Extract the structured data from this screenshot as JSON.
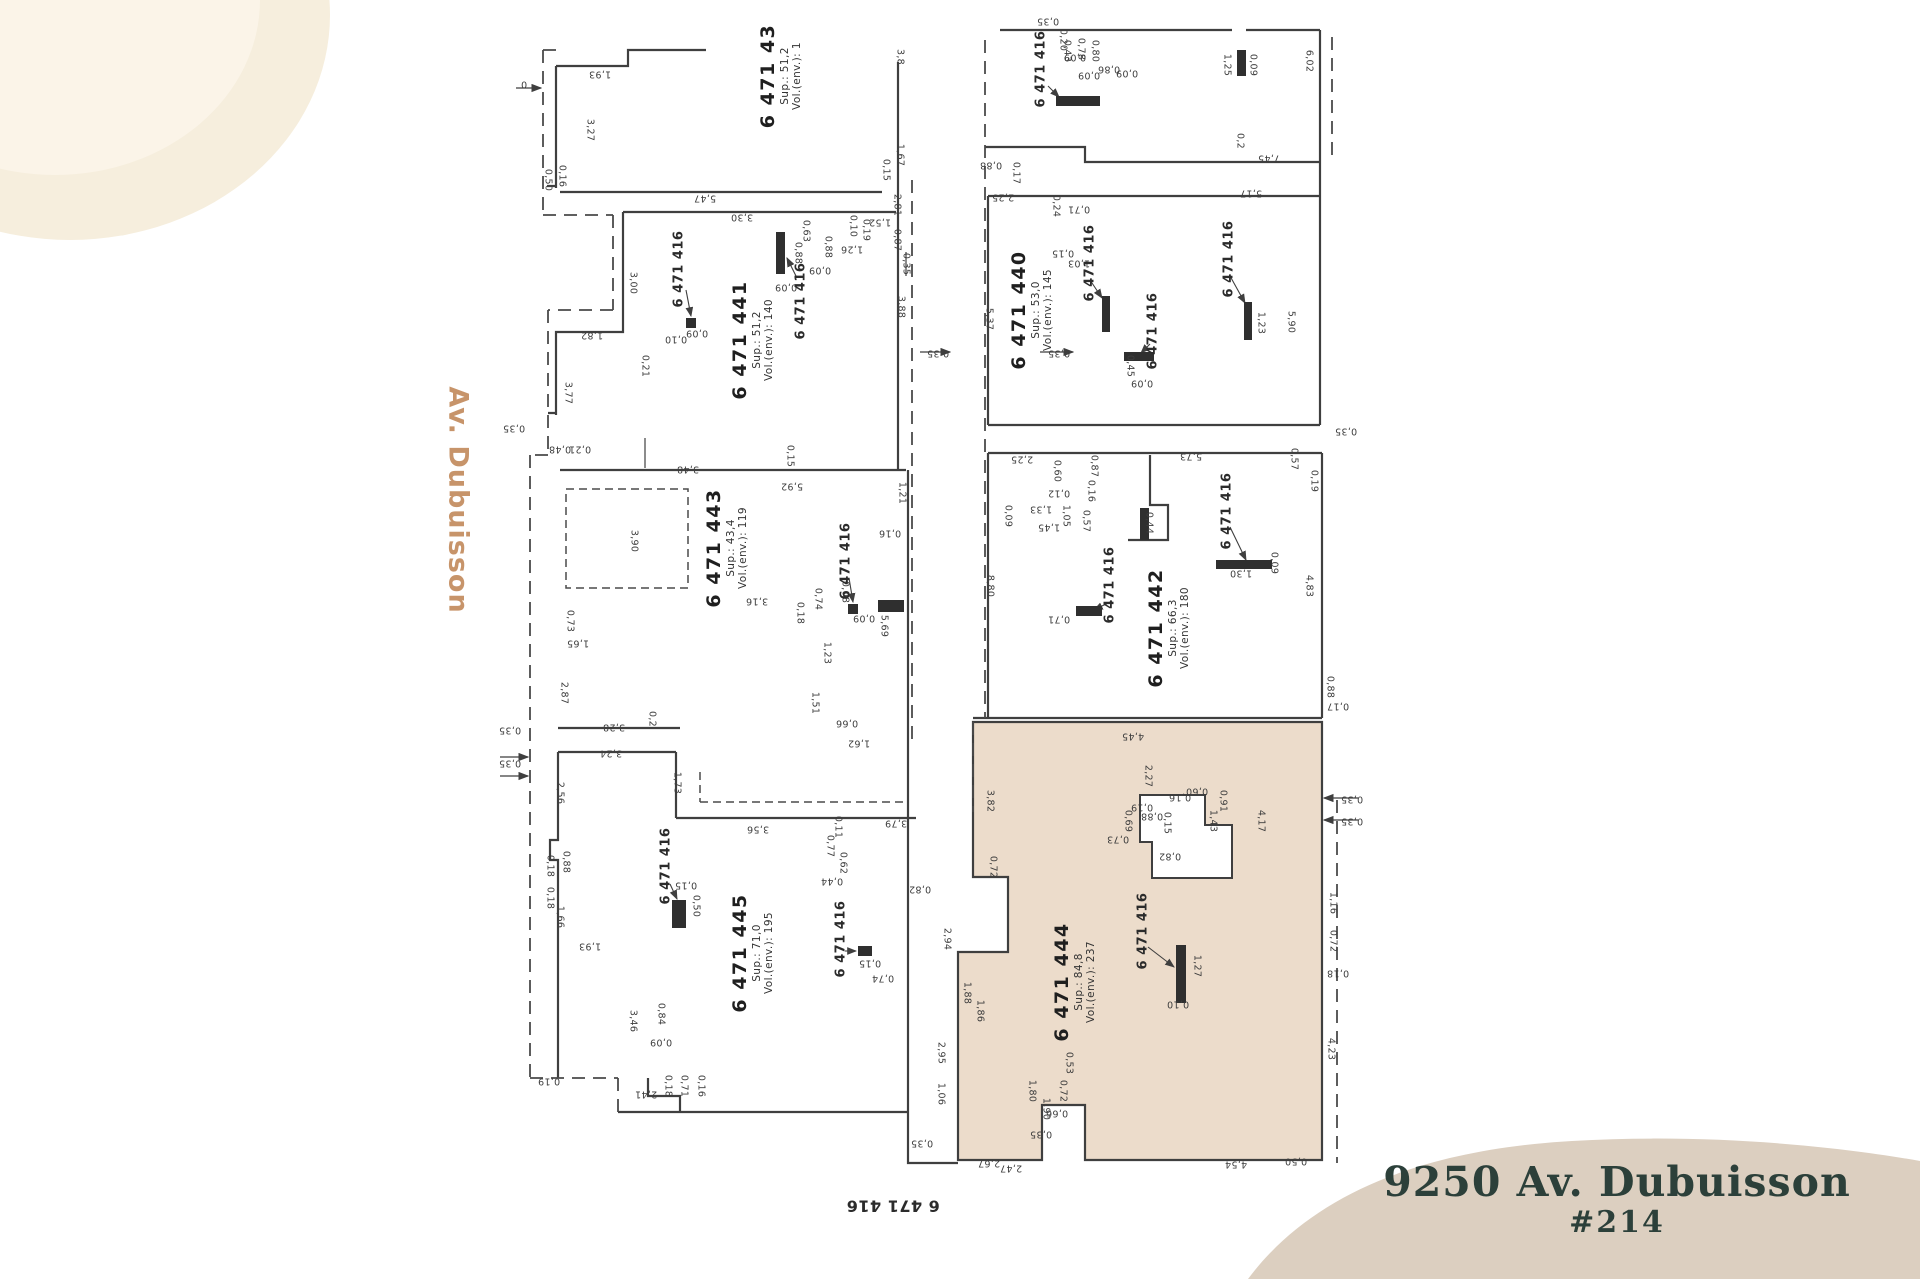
{
  "page": {
    "street_label": "Av. Dubuisson",
    "address": {
      "line1": "9250 Av. Dubuisson",
      "line2": "#214"
    }
  },
  "colors": {
    "highlight_fill": "#ecdccb",
    "footer_blob": "#dccfc0",
    "corner_blob_outer": "#f6eedd",
    "corner_blob_inner": "#fbf4e8",
    "street_label": "#c7946a",
    "address_text": "#2c403a",
    "plan_line": "#3f3f3f"
  },
  "plan": {
    "units": [
      {
        "id": "6 471 43",
        "sup": "Sup.: 51,2",
        "vol": "Vol.(env.): 1",
        "x": 780,
        "y": 76,
        "highlighted": false
      },
      {
        "id": "6 471 441",
        "sup": "Sup.: 51,2",
        "vol": "Vol.(env.): 140",
        "x": 752,
        "y": 340,
        "highlighted": false
      },
      {
        "id": "6 471 443",
        "sup": "Sup.: 43,4",
        "vol": "Vol.(env.): 119",
        "x": 726,
        "y": 548,
        "highlighted": false
      },
      {
        "id": "6 471 445",
        "sup": "Sup.: 71,0",
        "vol": "Vol.(env.): 195",
        "x": 752,
        "y": 953,
        "highlighted": false
      },
      {
        "id": "6 471 440",
        "sup": "Sup.: 53,0",
        "vol": "Vol.(env.): 145",
        "x": 1031,
        "y": 310,
        "highlighted": false
      },
      {
        "id": "6 471 442",
        "sup": "Sup.: 66,3",
        "vol": "Vol.(env.): 180",
        "x": 1168,
        "y": 628,
        "highlighted": false
      },
      {
        "id": "6 471 444",
        "sup": "Sup.: 84,8",
        "vol": "Vol.(env.): 237",
        "x": 1074,
        "y": 982,
        "highlighted": true
      }
    ],
    "lot_labels": [
      {
        "t": "6 471 416",
        "x": 679,
        "y": 269
      },
      {
        "t": "6 471 416",
        "x": 801,
        "y": 301
      },
      {
        "t": "6 471 416",
        "x": 1041,
        "y": 69
      },
      {
        "t": "6 471 416",
        "x": 1090,
        "y": 263
      },
      {
        "t": "6 471 416",
        "x": 1229,
        "y": 259
      },
      {
        "t": "6 471 416",
        "x": 1153,
        "y": 331
      },
      {
        "t": "6 471 416",
        "x": 1110,
        "y": 585
      },
      {
        "t": "6 471 416",
        "x": 1227,
        "y": 511
      },
      {
        "t": "6 471 416",
        "x": 846,
        "y": 561
      },
      {
        "t": "6 471 416",
        "x": 666,
        "y": 866
      },
      {
        "t": "6 471 416",
        "x": 841,
        "y": 939
      },
      {
        "t": "6 471 416",
        "x": 1143,
        "y": 931
      },
      {
        "t": "6 471 416",
        "x": 893,
        "y": 1206,
        "r": 180,
        "cls": "big"
      }
    ],
    "dims": [
      [
        "0",
        524,
        84,
        180
      ],
      [
        "1,93",
        600,
        74,
        180
      ],
      [
        "3,27",
        590,
        130,
        90
      ],
      [
        "0,50",
        548,
        180,
        90
      ],
      [
        "0,16",
        562,
        176,
        90
      ],
      [
        "5,47",
        705,
        198,
        180
      ],
      [
        "0,15",
        886,
        170,
        90
      ],
      [
        "3,8",
        900,
        57,
        90
      ],
      [
        "1,67",
        900,
        155,
        90
      ],
      [
        "2,81",
        897,
        205,
        90
      ],
      [
        "0,20",
        1063,
        40,
        90
      ],
      [
        "0,09",
        1075,
        57,
        180
      ],
      [
        "3,30",
        742,
        217,
        180
      ],
      [
        "0,63",
        806,
        231,
        90
      ],
      [
        "0,88",
        828,
        247,
        90
      ],
      [
        "0,09",
        820,
        270,
        180
      ],
      [
        "0,10",
        853,
        226,
        90
      ],
      [
        "0,19",
        866,
        230,
        90
      ],
      [
        "1,52",
        880,
        222,
        180
      ],
      [
        "1,26",
        852,
        249,
        180
      ],
      [
        "0,87",
        897,
        240,
        90
      ],
      [
        "0,35",
        906,
        264,
        90
      ],
      [
        "3,88",
        901,
        307,
        90
      ],
      [
        "3,00",
        633,
        283,
        90
      ],
      [
        "0,10",
        676,
        339,
        180
      ],
      [
        "0,09",
        697,
        333,
        180
      ],
      [
        "0,88",
        798,
        253,
        90
      ],
      [
        "0,09",
        786,
        287,
        180
      ],
      [
        "1,82",
        592,
        335,
        180
      ],
      [
        "3,77",
        568,
        393,
        90
      ],
      [
        "0,21",
        645,
        366,
        90
      ],
      [
        "0,48",
        560,
        449,
        180
      ],
      [
        "0,21",
        580,
        449,
        180
      ],
      [
        "3,48",
        688,
        469,
        180
      ],
      [
        "0,15",
        790,
        456,
        90
      ],
      [
        "5,92",
        792,
        486,
        180
      ],
      [
        "0,35",
        514,
        428,
        180
      ],
      [
        "3,90",
        634,
        541,
        90
      ],
      [
        "1,21",
        902,
        493,
        90
      ],
      [
        "0,16",
        890,
        533,
        180
      ],
      [
        "5,69",
        884,
        626,
        90
      ],
      [
        "3,16",
        757,
        601,
        180
      ],
      [
        "0,74",
        818,
        599,
        90
      ],
      [
        "0,18",
        800,
        613,
        90
      ],
      [
        "0,08",
        845,
        592,
        90
      ],
      [
        "0,09",
        864,
        618,
        180
      ],
      [
        "1,23",
        827,
        653,
        90
      ],
      [
        "1,51",
        815,
        703,
        90
      ],
      [
        "0,66",
        847,
        723,
        180
      ],
      [
        "1,62",
        859,
        743,
        180
      ],
      [
        "0,73",
        570,
        621,
        90
      ],
      [
        "1,65",
        578,
        643,
        180
      ],
      [
        "2,87",
        564,
        693,
        90
      ],
      [
        "3,28",
        614,
        727,
        180
      ],
      [
        "3,24",
        611,
        753,
        180
      ],
      [
        "0,2",
        652,
        719,
        90
      ],
      [
        "1,73",
        677,
        783,
        90
      ],
      [
        "3,56",
        758,
        829,
        180
      ],
      [
        "0,35",
        510,
        730,
        180
      ],
      [
        "0,35",
        510,
        763,
        180
      ],
      [
        "2,56",
        560,
        793,
        90
      ],
      [
        "0,18",
        550,
        866,
        90
      ],
      [
        "0,88",
        566,
        862,
        90
      ],
      [
        "0,18",
        550,
        898,
        90
      ],
      [
        "1,66",
        560,
        917,
        90
      ],
      [
        "1,93",
        590,
        946,
        180
      ],
      [
        "3,46",
        633,
        1021,
        90
      ],
      [
        "0,15",
        686,
        885,
        180
      ],
      [
        "0,50",
        696,
        906,
        90
      ],
      [
        "0,84",
        661,
        1014,
        90
      ],
      [
        "0,09",
        661,
        1042,
        180
      ],
      [
        "0,19",
        549,
        1081,
        180
      ],
      [
        "2,41",
        646,
        1094,
        180
      ],
      [
        "0,18",
        668,
        1086,
        90
      ],
      [
        "0,71",
        684,
        1086,
        90
      ],
      [
        "0,16",
        701,
        1086,
        90
      ],
      [
        "3,79",
        896,
        823,
        180
      ],
      [
        "0,11",
        838,
        827,
        90
      ],
      [
        "0,77",
        830,
        846,
        90
      ],
      [
        "0,62",
        843,
        863,
        90
      ],
      [
        "0,44",
        832,
        881,
        180
      ],
      [
        "0,15",
        870,
        963,
        180
      ],
      [
        "0,74",
        883,
        978,
        180
      ],
      [
        "2,95",
        941,
        1053,
        90
      ],
      [
        "1,06",
        941,
        1094,
        90
      ],
      [
        "0,35",
        922,
        1143,
        180
      ],
      [
        "2,67",
        989,
        1163,
        180
      ],
      [
        "1,86",
        980,
        1011,
        90
      ],
      [
        "8,80",
        990,
        586,
        90
      ],
      [
        "4,45",
        1133,
        736,
        180
      ],
      [
        "2,27",
        1148,
        776,
        90
      ],
      [
        "3,82",
        990,
        801,
        90
      ],
      [
        "0,88",
        1152,
        816,
        180
      ],
      [
        "0,15",
        1167,
        823,
        90
      ],
      [
        "0,69",
        1128,
        821,
        90
      ],
      [
        "0,19",
        1142,
        807,
        180
      ],
      [
        "0,73",
        1118,
        839,
        180
      ],
      [
        "1,43",
        1213,
        821,
        90
      ],
      [
        "0,91",
        1223,
        801,
        90
      ],
      [
        "0,60",
        1197,
        791,
        180
      ],
      [
        "0,82",
        1170,
        856,
        180
      ],
      [
        "4,17",
        1261,
        821,
        90
      ],
      [
        "1,88",
        967,
        993,
        90
      ],
      [
        "2,94",
        947,
        939,
        90
      ],
      [
        "0,82",
        920,
        889,
        180
      ],
      [
        "0,72",
        993,
        867,
        90
      ],
      [
        "1,27",
        1197,
        966,
        90
      ],
      [
        "0,10",
        1178,
        1004,
        180
      ],
      [
        "1,80",
        1032,
        1091,
        90
      ],
      [
        "1,90",
        1046,
        1109,
        90
      ],
      [
        "0,66",
        1057,
        1113,
        180
      ],
      [
        "0,72",
        1063,
        1091,
        90
      ],
      [
        "0,53",
        1069,
        1063,
        90
      ],
      [
        "0,35",
        1041,
        1134,
        180
      ],
      [
        "2,47",
        1011,
        1168,
        180
      ],
      [
        "4,54",
        1236,
        1164,
        180
      ],
      [
        "0,50",
        1296,
        1161,
        180
      ],
      [
        "4,23",
        1331,
        1049,
        90
      ],
      [
        "0,18",
        1338,
        973,
        180
      ],
      [
        "0,72",
        1333,
        941,
        90
      ],
      [
        "1,16",
        1333,
        903,
        90
      ],
      [
        "0,35",
        1352,
        799,
        180
      ],
      [
        "0,35",
        1352,
        821,
        180
      ],
      [
        "0,16",
        1180,
        797,
        180
      ],
      [
        "2,25",
        1022,
        459,
        180
      ],
      [
        "0,60",
        1057,
        471,
        90
      ],
      [
        "0,12",
        1059,
        493,
        180
      ],
      [
        "1,05",
        1066,
        516,
        90
      ],
      [
        "1,33",
        1041,
        509,
        180
      ],
      [
        "1,45",
        1049,
        527,
        180
      ],
      [
        "0,09",
        1008,
        516,
        90
      ],
      [
        "0,16",
        1091,
        491,
        90
      ],
      [
        "0,87",
        1094,
        466,
        90
      ],
      [
        "0,57",
        1086,
        521,
        90
      ],
      [
        "5,73",
        1191,
        456,
        180
      ],
      [
        "0,57",
        1294,
        459,
        90
      ],
      [
        "0,19",
        1314,
        481,
        90
      ],
      [
        "4,83",
        1309,
        586,
        90
      ],
      [
        "0,44",
        1149,
        523,
        90
      ],
      [
        "1,30",
        1241,
        573,
        180
      ],
      [
        "0,09",
        1274,
        563,
        90
      ],
      [
        "0,71",
        1059,
        619,
        180
      ],
      [
        "0,88",
        1330,
        687,
        90
      ],
      [
        "0,17",
        1338,
        706,
        180
      ],
      [
        "2,25",
        1003,
        197,
        180
      ],
      [
        "0,24",
        1056,
        206,
        90
      ],
      [
        "0,71",
        1079,
        209,
        180
      ],
      [
        "0,17",
        1016,
        173,
        90
      ],
      [
        "0,88",
        991,
        165,
        180
      ],
      [
        "5,17",
        1251,
        193,
        180
      ],
      [
        "7,45",
        1269,
        158,
        180
      ],
      [
        "0,2",
        1240,
        141,
        90
      ],
      [
        "5,37",
        989,
        319,
        90
      ],
      [
        "1,03",
        1079,
        263,
        180
      ],
      [
        "0,15",
        1063,
        253,
        180
      ],
      [
        "0,45",
        1130,
        366,
        90
      ],
      [
        "0,09",
        1142,
        383,
        180
      ],
      [
        "1,23",
        1261,
        323,
        90
      ],
      [
        "5,90",
        1291,
        322,
        90
      ],
      [
        "0,35",
        1059,
        353,
        180
      ],
      [
        "0,35",
        938,
        353,
        180
      ],
      [
        "0,35",
        1346,
        431,
        180
      ],
      [
        "0,35",
        1048,
        21,
        180
      ],
      [
        "0,43",
        1067,
        51,
        90
      ],
      [
        "0,78",
        1081,
        49,
        90
      ],
      [
        "0,80",
        1095,
        51,
        90
      ],
      [
        "0,09",
        1089,
        75,
        180
      ],
      [
        "0,86",
        1109,
        69,
        180
      ],
      [
        "0,09",
        1127,
        73,
        180
      ],
      [
        "1,25",
        1227,
        65,
        90
      ],
      [
        "0,09",
        1253,
        65,
        90
      ],
      [
        "6,02",
        1309,
        61,
        90
      ]
    ]
  }
}
